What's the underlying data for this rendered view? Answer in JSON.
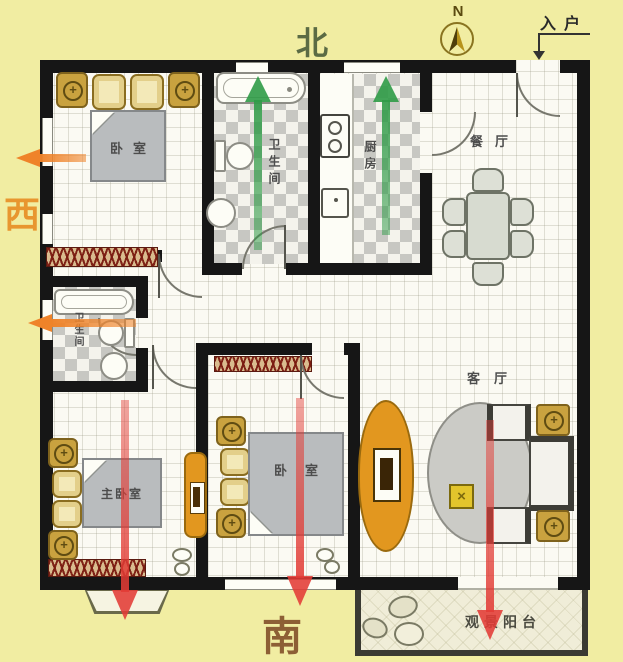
{
  "compass": {
    "letter": "N"
  },
  "entry": {
    "label": "入户"
  },
  "directions": {
    "north": "北",
    "south": "南",
    "west": "西"
  },
  "rooms": {
    "bedroom_nw": {
      "label": "卧室"
    },
    "bath_n": {
      "label": "卫生间"
    },
    "kitchen": {
      "label": "厨房"
    },
    "dining": {
      "label": "餐厅"
    },
    "bath_w": {
      "label": "卫生间"
    },
    "master": {
      "label": "主卧室"
    },
    "bedroom_s": {
      "label": "卧室"
    },
    "living": {
      "label": "客厅"
    },
    "balcony": {
      "label": "观景阳台"
    }
  },
  "arrows": [
    {
      "id": "north-bath-arrow",
      "direction": "up",
      "color": "#2f9b47"
    },
    {
      "id": "north-kitchen-arrow",
      "direction": "up",
      "color": "#2f9b47"
    },
    {
      "id": "master-south-arrow",
      "direction": "down",
      "color": "#e23b35"
    },
    {
      "id": "bedroom-south-arrow",
      "direction": "down",
      "color": "#e23b35"
    },
    {
      "id": "living-south-arrow",
      "direction": "down",
      "color": "#e23b35"
    },
    {
      "id": "west-bedroom-arrow",
      "direction": "left",
      "color": "#ef8329"
    },
    {
      "id": "west-bath-arrow",
      "direction": "left",
      "color": "#ef8329"
    }
  ],
  "colors": {
    "background": "#f1eda2",
    "wall": "#161616",
    "wood_accent": "#c9a23f",
    "orange_furniture": "#e2971f",
    "green_arrow": "#2f9b47",
    "red_arrow": "#e23b35",
    "orange_arrow": "#ef8329",
    "north_text": "#5b6b44",
    "west_text": "#e8962f",
    "south_text": "#8d5f35"
  }
}
